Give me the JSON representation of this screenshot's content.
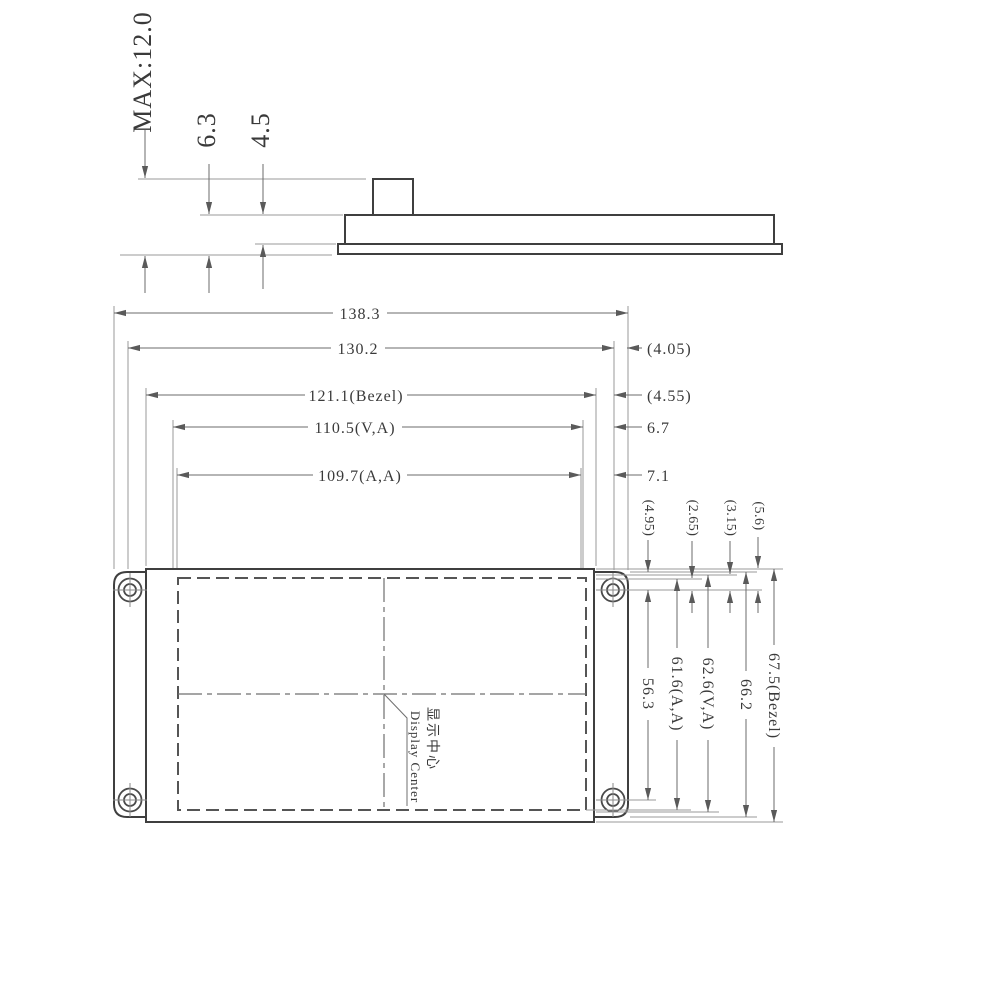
{
  "meta": {
    "drawing_type": "display-module-dimension-drawing",
    "line_ink": "#3f3f3f"
  },
  "side_view": {
    "max_height": "MAX:12.0",
    "thickness_with_flange": "6.3",
    "thickness_body": "4.5"
  },
  "front_view": {
    "widths": {
      "total": "138.3",
      "outline": "130.2",
      "bezel": "121.1(Bezel)",
      "viewing_area": "110.5(V,A)",
      "active_area": "109.7(A,A)"
    },
    "right_offsets": {
      "r1": "(4.05)",
      "r2": "(4.55)",
      "r3": "6.7",
      "r4": "7.1"
    },
    "top_offsets": {
      "t1": "(4.95)",
      "t2": "(2.65)",
      "t3": "(3.15)",
      "t4": "(5.6)"
    },
    "heights": {
      "hole_pitch": "56.3",
      "active_area": "61.6(A,A)",
      "viewing_area": "62.6(V,A)",
      "outline": "66.2",
      "bezel": "67.5(Bezel)"
    },
    "center_note_zh": "显示中心",
    "center_note_en": "Display Center"
  }
}
